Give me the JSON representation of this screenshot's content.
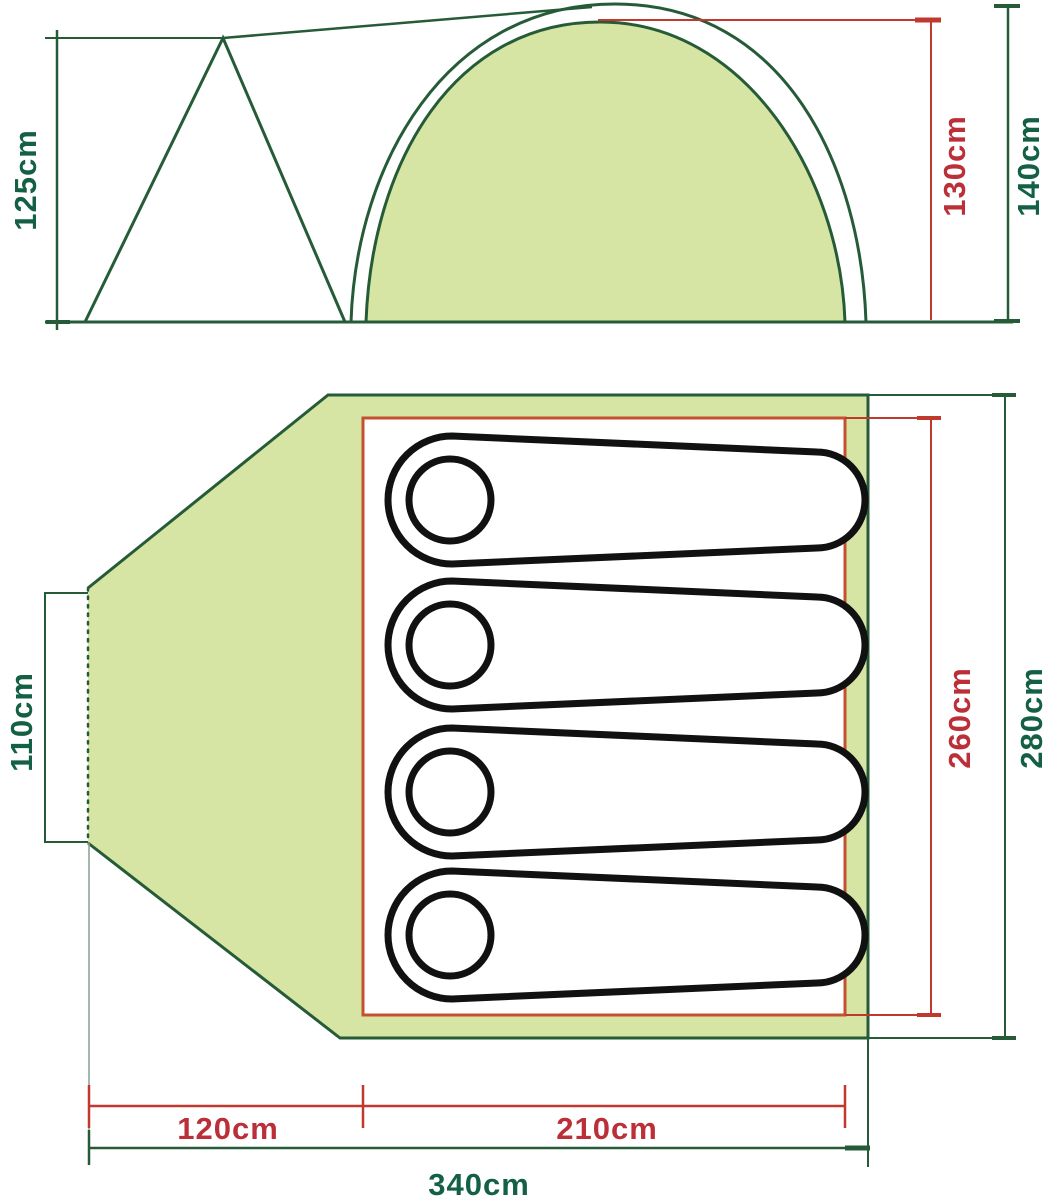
{
  "diagram": {
    "subject": "tent-dimension-diagram",
    "views": [
      "side-elevation",
      "floor-plan"
    ]
  },
  "side_view": {
    "porch_height": "125cm",
    "inner_height": "130cm",
    "outer_height": "140cm"
  },
  "floor_plan": {
    "door_width": "110cm",
    "inner_width": "260cm",
    "outer_width": "280cm",
    "porch_length": "120cm",
    "sleeping_length": "210cm",
    "total_length": "340cm",
    "sleeping_bag_count": 4
  },
  "colors": {
    "outline_green": "#265b38",
    "text_green": "#136044",
    "dimension_red": "#c0392e",
    "text_red": "#bb3038",
    "fill_light_green": "#d6e5a4",
    "inner_border_orange": "#c4502f",
    "bag_outline_black": "#111111"
  }
}
